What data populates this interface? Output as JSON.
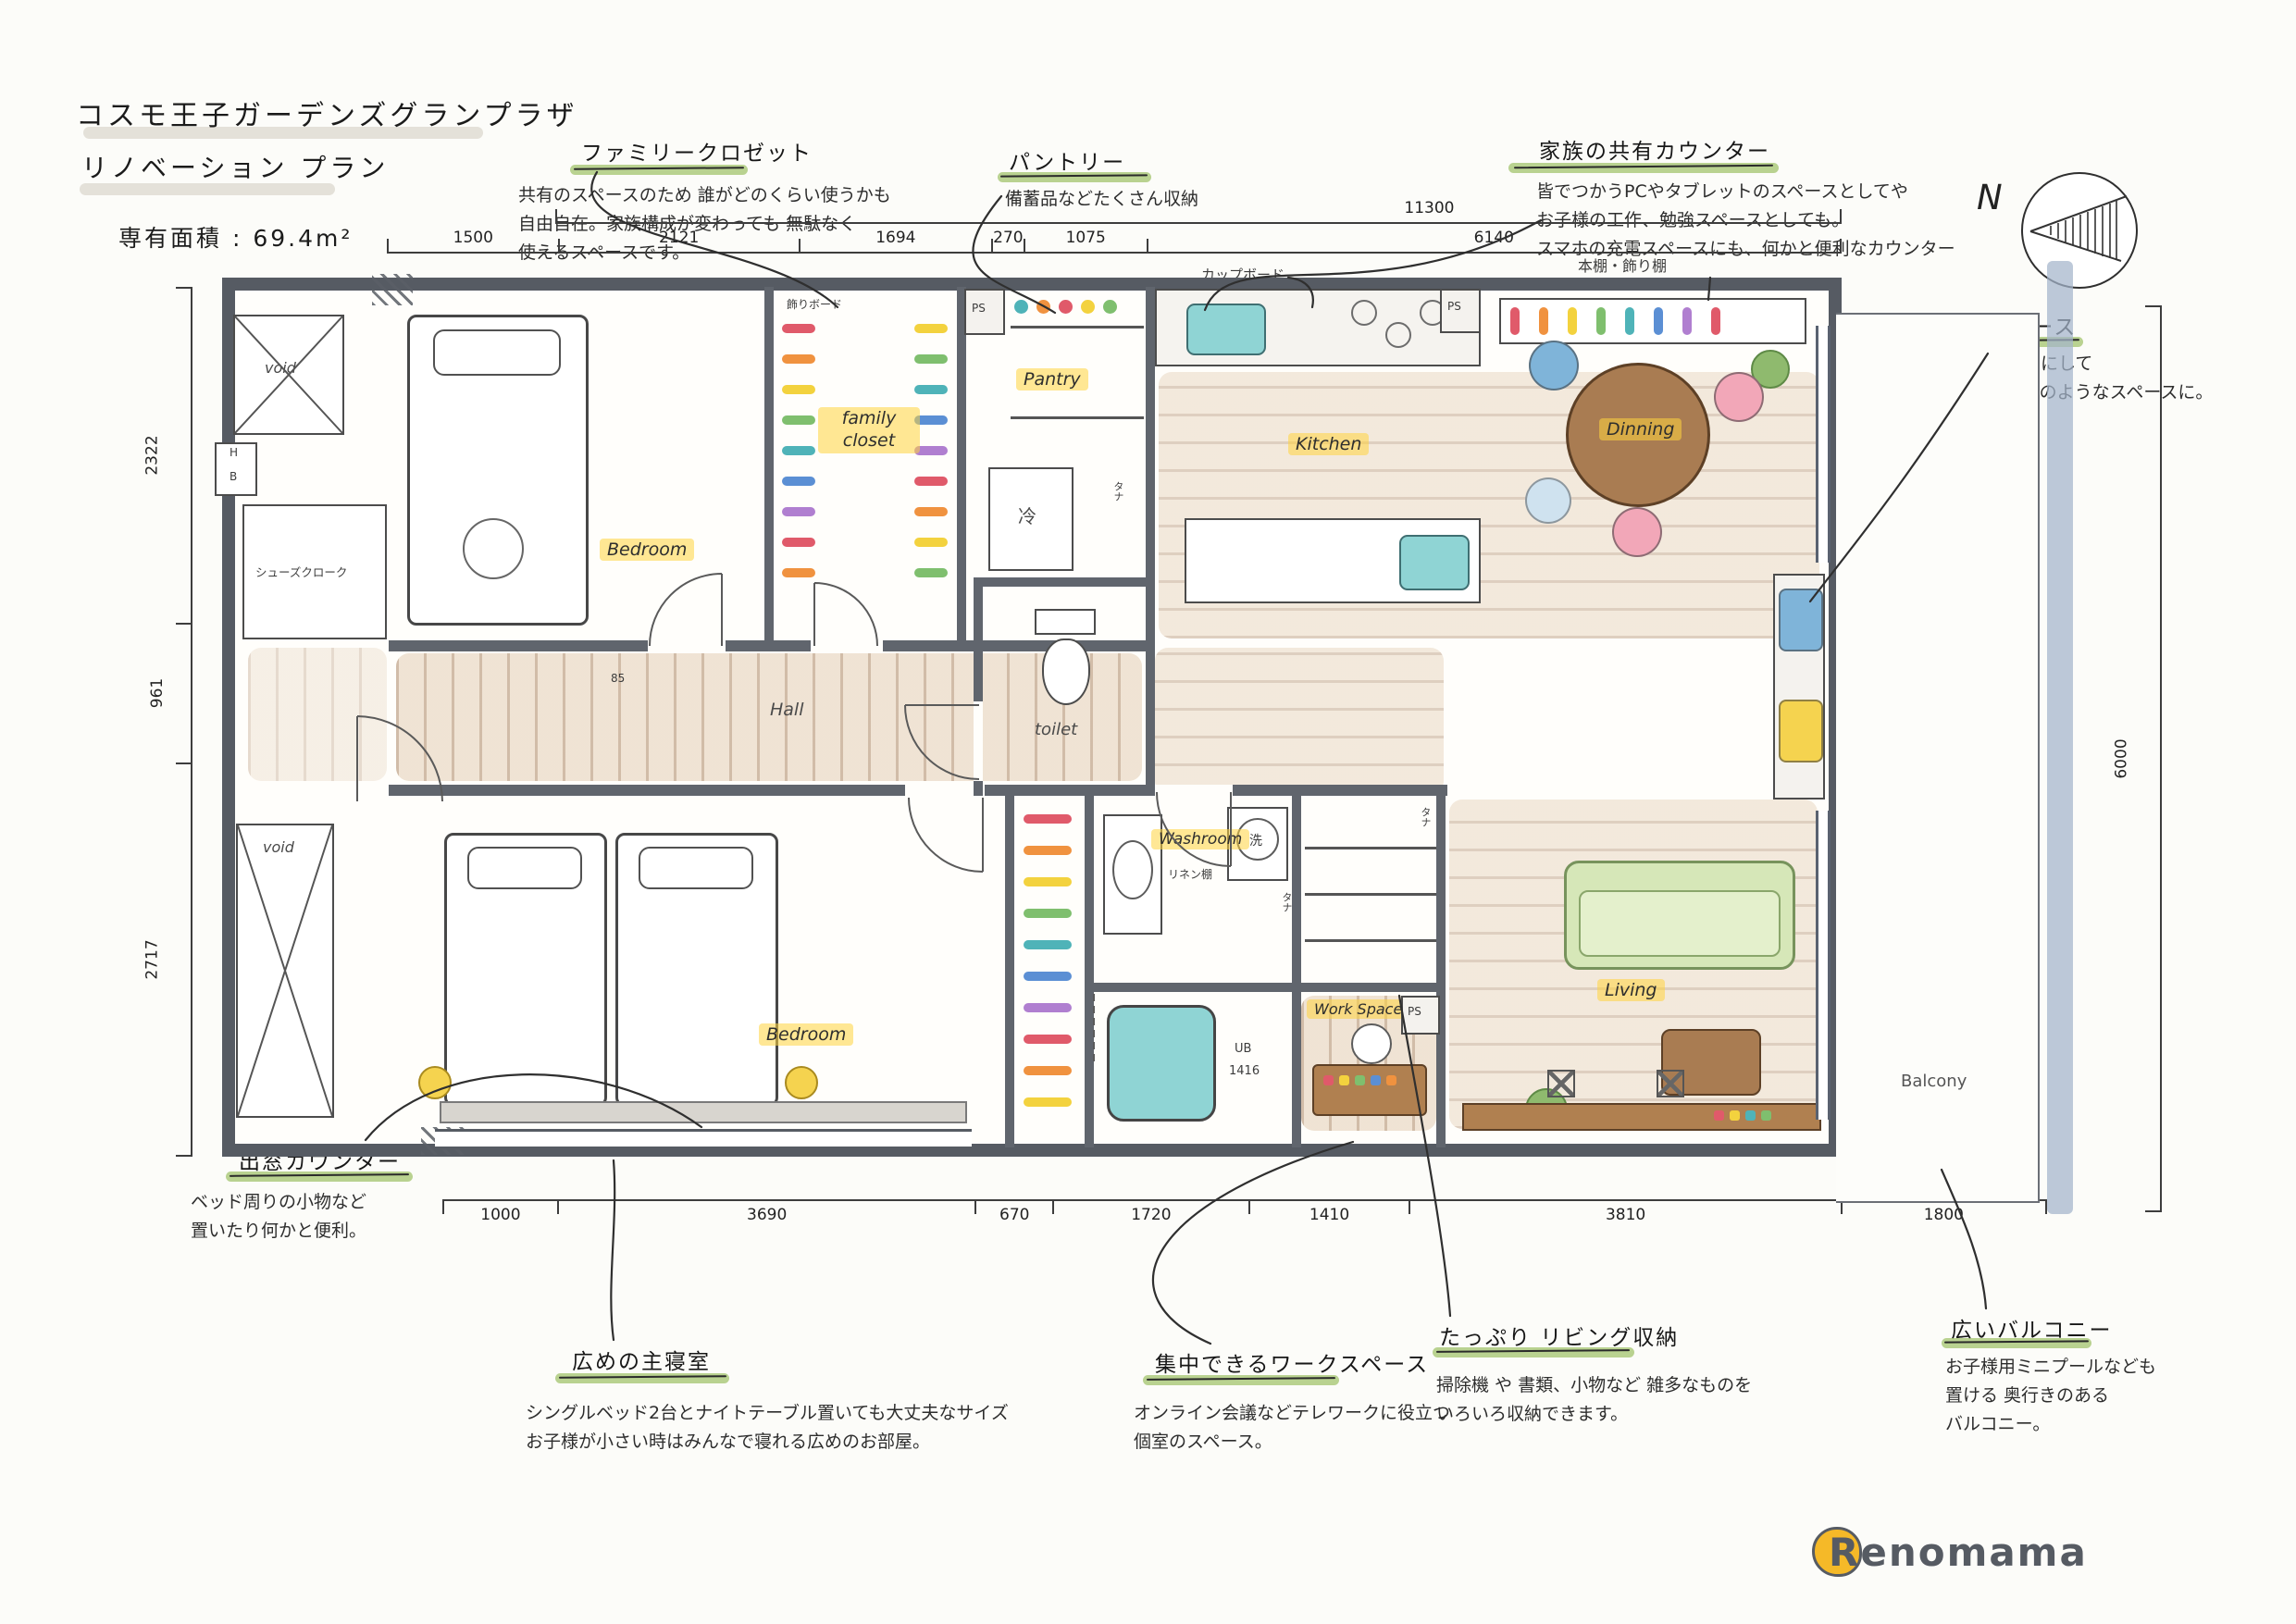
{
  "title": {
    "building": "コスモ王子ガーデンズグランプラザ",
    "plan": "リノベーション プラン",
    "area": "専有面積 : 69.4m²"
  },
  "compass": {
    "label": "N"
  },
  "logo": {
    "text": "Renomama"
  },
  "annotations": {
    "family_closet": {
      "label": "ファミリークロゼット",
      "desc": "共有のスペースのため 誰がどのくらい使うかも\n自由自在。家族構成が変わっても 無駄なく\n使えるスペースです。"
    },
    "pantry": {
      "label": "パントリー",
      "desc": "備蓄品などたくさん収納"
    },
    "family_counter": {
      "label": "家族の共有カウンター",
      "desc": "皆でつかうPCやタブレットのスペースとしてや\nお子様の工作、勉強スペースとしても。\nスマホの充電スペースにも、何かと便利なカウンター"
    },
    "bench_space": {
      "label": "ベンチスペース",
      "desc": "低めの出窓をベンチにして\nリーディングヌックのようなスペースに。"
    },
    "bay_counter": {
      "label": "出窓カウンター",
      "desc": "ベッド周りの小物など\n置いたり何かと便利。"
    },
    "master_bedroom": {
      "label": "広めの主寝室",
      "desc": "シングルベッド2台とナイトテーブル置いても大丈夫なサイズ\nお子様が小さい時はみんなで寝れる広めのお部屋。"
    },
    "work_space": {
      "label": "集中できるワークスペース",
      "desc": "オンライン会議などテレワークに役立つ\n個室のスペース。"
    },
    "living_storage": {
      "label": "たっぷり リビング収納",
      "desc": "掃除機 や 書類、小物など 雑多なものを\nいろいろ収納できます。"
    },
    "wide_balcony": {
      "label": "広いバルコニー",
      "desc": "お子様用ミニプールなども\n置ける 奥行きのある\nバルコニー。"
    }
  },
  "dimensions": {
    "top_total": "11300",
    "top": [
      "1500",
      "2121",
      "1694",
      "270",
      "1075",
      "6140"
    ],
    "left": [
      "2322",
      "961",
      "2717"
    ],
    "right": "6000",
    "bottom": [
      "1000",
      "3690",
      "670",
      "1720",
      "1410",
      "3810",
      "1800"
    ]
  },
  "rooms": {
    "bedroom": "Bedroom",
    "family_closet": "family closet",
    "toilet": "toilet",
    "pantry": "Pantry",
    "fridge": "冷",
    "kitchen": "Kitchen",
    "dining": "Dinning",
    "hall": "Hall",
    "shoes_closet": "シューズクローク",
    "void": "void",
    "washroom": "Washroom",
    "washer": "洗",
    "linen": "リネン棚",
    "ub": "UB",
    "ub_size": "1416",
    "workspace": "Work Space",
    "living": "Living",
    "balcony": "Balcony",
    "hb_h": "H",
    "hb_b": "B",
    "ps": "PS",
    "tana": "タナ",
    "cupboard": "カップボード",
    "bookshelf": "本棚・飾り棚",
    "kazari_board": "飾りボード",
    "door_85": "85"
  },
  "colors": {
    "highlight_yellow": "#ffd33e",
    "marker_green": "#a8c776",
    "wall_gray": "#565b63",
    "wood_brown": "#a97c52",
    "water_teal": "#8fd4d4",
    "sofa_green": "#d6e7b8",
    "cushion_blue": "#7fb4d9",
    "cushion_pink": "#f2a7b8",
    "cushion_yellow": "#f5d34f",
    "balcony_line_blue": "#a3b4cb",
    "logo_yellow": "#f5b928"
  }
}
